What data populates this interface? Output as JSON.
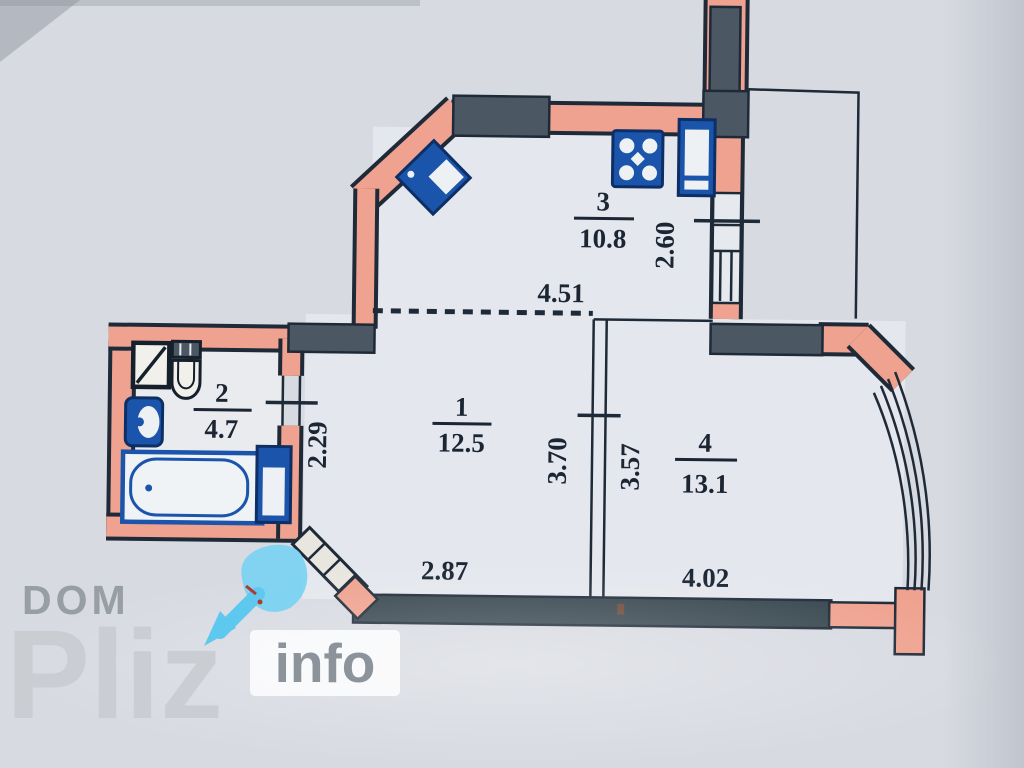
{
  "title": "Apartment floor plan scan",
  "rooms": [
    {
      "number": "1",
      "area": "12.5"
    },
    {
      "number": "2",
      "area": "4.7"
    },
    {
      "number": "3",
      "area": "10.8"
    },
    {
      "number": "4",
      "area": "13.1"
    }
  ],
  "dimensions": {
    "kitchen_width": "4.51",
    "kitchen_depth": "2.60",
    "bath_wall": "2.29",
    "hall_depth": "3.70",
    "room4_depth": "3.57",
    "hall_width": "2.87",
    "room4_width": "4.02"
  },
  "watermark": {
    "prefix": "DOM",
    "brand": "Pliz",
    "suffix": "info"
  },
  "fixtures": [
    "washing-machine-icon",
    "toilet-icon",
    "sink-icon",
    "bathtub-icon",
    "water-heater-icon",
    "kitchen-sink-icon",
    "stove-icon",
    "fridge-icon",
    "entrance-door-icon",
    "bay-window",
    "balcony-outline"
  ],
  "colors": {
    "paper": "#d7dae1",
    "wall_pink": "#efa28f",
    "wall_slate": "#4b5863",
    "outline": "#1e2a38",
    "fixture_blue": "#1b54ab",
    "watermark_cyan": "#6fd0f2"
  }
}
